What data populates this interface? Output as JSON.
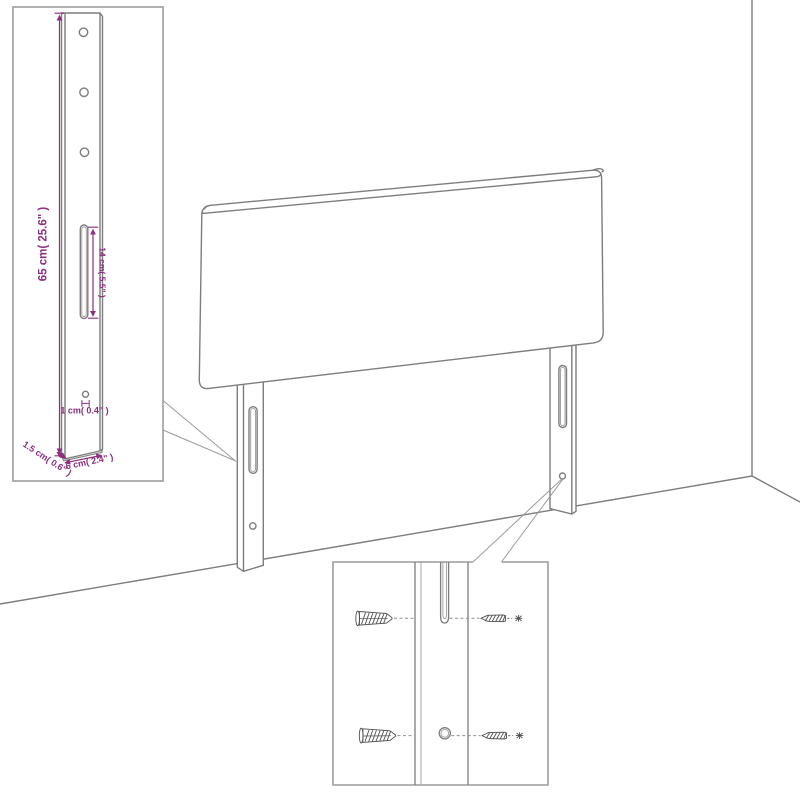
{
  "diagram": {
    "kind": "headboard-assembly-dimension-diagram",
    "colors": {
      "line_gray": "#7d7d7d",
      "inset_border_gray": "#9c9c9c",
      "dimension_magenta": "#8b2e7d",
      "hardware_dark": "#4f4f4f",
      "background": "#ffffff"
    },
    "leg_detail_inset": {
      "holes_top": 3,
      "labels": {
        "height": "65 cm( 25.6\" )",
        "slot_length": "14 cm( 5.5\" )",
        "hole_diameter": "1 cm( 0.4\" )",
        "side_thickness": "1.5 cm( 0.6\" )",
        "front_width": "6 cm( 2.4\" )"
      }
    },
    "main_view": {
      "elements": [
        "headboard-panel",
        "left-leg",
        "right-leg",
        "wall-corner",
        "floor"
      ],
      "slots_per_leg": 1,
      "holes_per_leg": 1
    },
    "mounting_inset": {
      "rows": 2,
      "hardware_per_row": [
        "wall-plug",
        "leg-slot-or-hole",
        "screw"
      ]
    }
  }
}
